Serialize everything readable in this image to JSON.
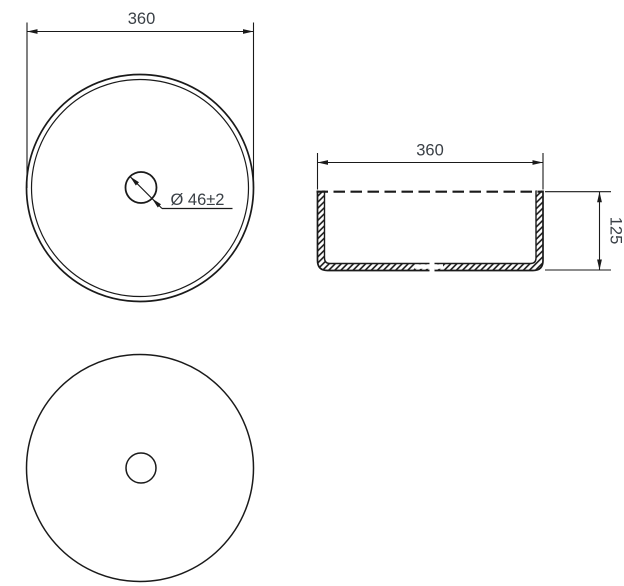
{
  "drawing": {
    "top_view": {
      "width_label": "360",
      "drain_label": "Ø 46±2"
    },
    "side_view": {
      "width_label": "360",
      "height_label": "125"
    },
    "colors": {
      "line": "#1a1a1a",
      "text": "#3a4046",
      "background": "#ffffff"
    }
  }
}
